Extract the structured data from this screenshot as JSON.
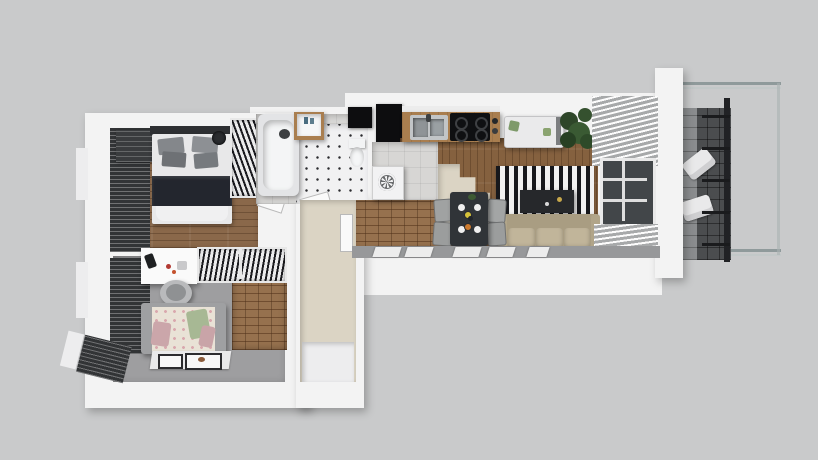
{
  "scene": {
    "title": "Top-down 3D render of an apartment floor plan",
    "background_color": "#c9cacb",
    "wall_color": "#f3f3f3"
  },
  "rooms": {
    "bedroom": {
      "name": "Bedroom",
      "floor": "wood",
      "floor_color": "#8a684a",
      "furniture": [
        "double-bed",
        "open-wardrobe",
        "dresser",
        "window-blinds"
      ]
    },
    "kids_room": {
      "name": "Second bedroom / study",
      "floor": "gray carpet",
      "floor_color": "#9e9ea0",
      "furniture": [
        "desk",
        "office-chair",
        "open-wardrobe",
        "daybed",
        "rug-with-posters",
        "window-blinds",
        "brick-accent-wall"
      ]
    },
    "bathroom": {
      "name": "Bathroom",
      "floor": "white tile with black dots",
      "floor_color": "#f1f1f2",
      "furniture": [
        "bathtub",
        "washbasin",
        "toilet",
        "black-cabinet"
      ]
    },
    "hallway": {
      "name": "Hallway / entrance",
      "floor_color": "#dbd4c4",
      "furniture": [
        "doors",
        "washing-machine",
        "brick-accent-wall"
      ]
    },
    "kitchen": {
      "name": "Kitchen / dining",
      "floor": "wood",
      "floor_color": "#85613f",
      "furniture": [
        "tall-black-units",
        "countertop",
        "sink",
        "cooktop",
        "dining-table",
        "four-chairs",
        "plates-with-food"
      ]
    },
    "living_room": {
      "name": "Living room",
      "floor": "wood",
      "floor_color": "#85613f",
      "furniture": [
        "striped-rug",
        "tv-console",
        "sofa",
        "daybed-bench",
        "plant",
        "window",
        "louver-blinds"
      ]
    },
    "balcony": {
      "name": "Balcony",
      "floor": "dark tile",
      "floor_color": "#4b4d4f",
      "furniture": [
        "lounge-chair",
        "lounge-chair",
        "glass-railing",
        "black-rail-frame"
      ]
    }
  },
  "palette": {
    "background": "#c9cacb",
    "walls": "#f3f3f3",
    "wood_floor": "#8a684a",
    "kitchen_wood": "#85613f",
    "brick_wall": "#96714e",
    "gray_floor": "#9e9ea0",
    "beige_floor": "#dbd4c4",
    "rug_stripe_dark": "#17181c",
    "rug_stripe_light": "#f1f1f1",
    "sofa_beige": "#b3a78b",
    "bed_blanket": "#23262e",
    "pillow_gray": "#8d9094",
    "daybed_pink_pillow": "#cba6aa",
    "daybed_green_pillow": "#a7b894",
    "plant_green": "#3a5a33",
    "appliance_black": "#0d0d0f",
    "counter_wood": "#a97e4f",
    "balcony_tile": "#4b4d4f",
    "glass_line": "#9aa4a5"
  }
}
